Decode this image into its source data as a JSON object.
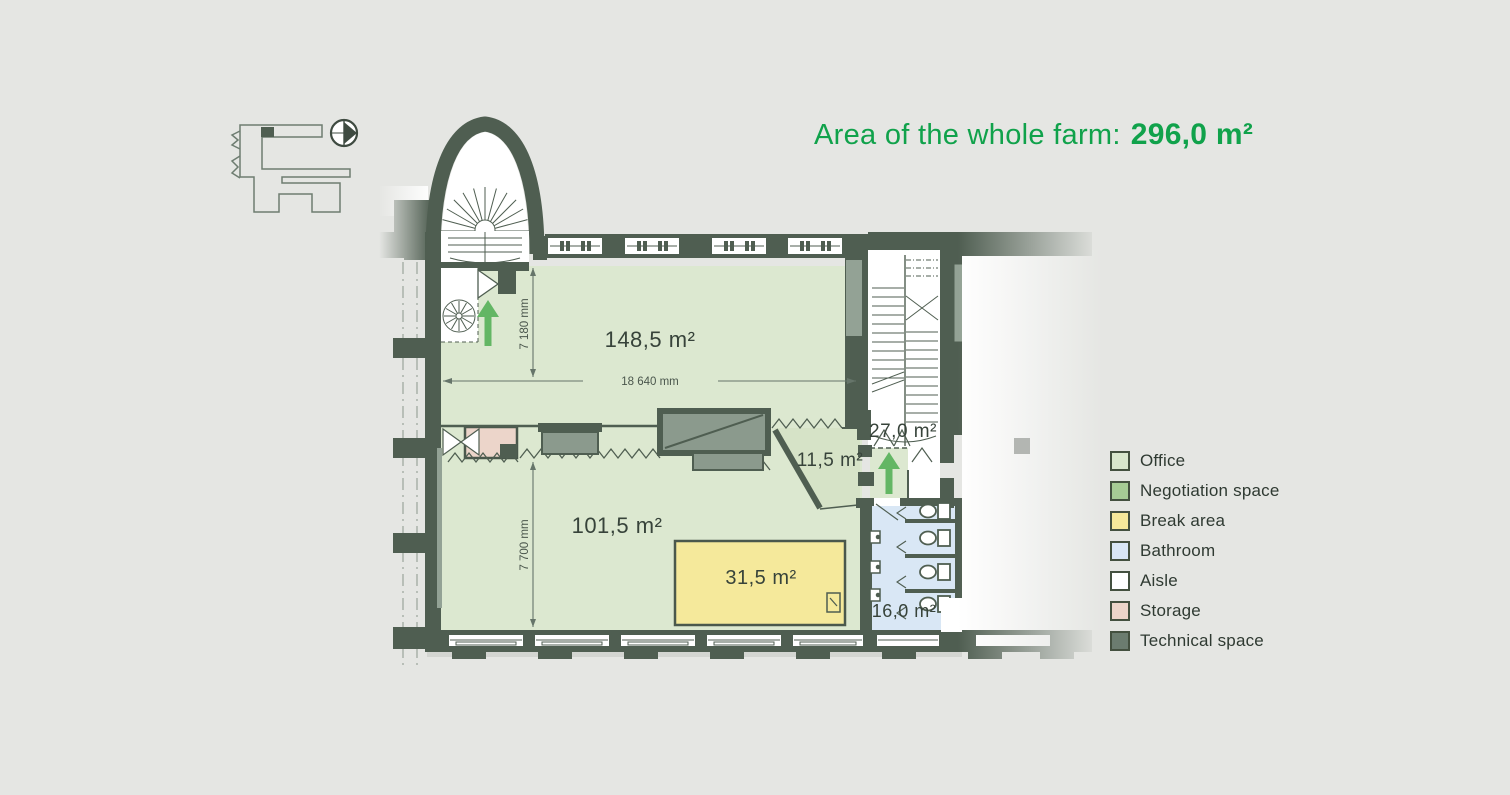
{
  "title": {
    "prefix": "Area of the whole farm:",
    "area_value": "296,0 m²"
  },
  "plan": {
    "room_labels": {
      "office_main": "148,5 m²",
      "office_lower": "101,5 m²",
      "break_area": "31,5 m²",
      "negotiation": "11,5 m²",
      "aisle": "27,0 m²",
      "bathroom": "16,0 m²"
    },
    "dimensions": {
      "width_top": "7 180 mm",
      "length_main": "18 640 mm",
      "width_bottom": "7 700 mm"
    }
  },
  "legend": {
    "items": [
      {
        "label": "Office",
        "color": "#d8e6cc"
      },
      {
        "label": "Negotiation space",
        "color": "#a6cb95"
      },
      {
        "label": "Break area",
        "color": "#f5e99b"
      },
      {
        "label": "Bathroom",
        "color": "#d9e7f5"
      },
      {
        "label": "Aisle",
        "color": "#ffffff"
      },
      {
        "label": "Storage",
        "color": "#ecd5ca"
      },
      {
        "label": "Technical space",
        "color": "#6b7c6f"
      }
    ]
  },
  "colors": {
    "accent_green": "#10a24b",
    "wall": "#4f5e51",
    "office_fill": "#dce8d0",
    "arrow_green": "#63b664",
    "background": "#e5e6e3"
  }
}
